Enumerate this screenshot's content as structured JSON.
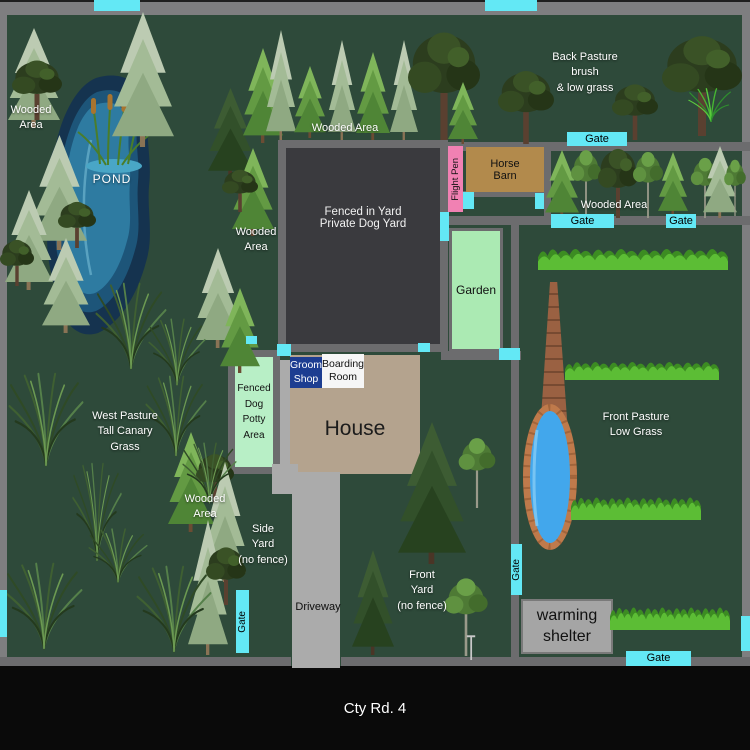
{
  "bottom_road_label": "Cty Rd. 4",
  "areas": {
    "pond": "POND",
    "fenced_yard": "Fenced in Yard\nPrivate Dog Yard",
    "garden": "Garden",
    "horse_barn": "Horse\nBarn",
    "flight_pen": "Flight Pen",
    "house": "House",
    "groom_shop": "Groom\nShop",
    "boarding_room": "Boarding\nRoom",
    "potty_area": "Fenced\nDog\nPotty\nArea",
    "warming_shelter": "warming\nshelter",
    "driveway": "Driveway"
  },
  "regions": {
    "wooded_nw": "Wooded\nArea",
    "wooded_top": "Wooded Area",
    "wooded_mid": "Wooded\nArea",
    "wooded_east": "Wooded Area",
    "wooded_sw": "Wooded\nArea",
    "back_pasture": "Back Pasture\nbrush\n& low grass",
    "west_pasture": "West Pasture\nTall Canary\nGrass",
    "front_pasture": "Front Pasture\nLow Grass",
    "side_yard": "Side\nYard\n(no fence)",
    "front_yard": "Front\nYard\n(no fence)"
  },
  "gates": [
    {
      "x": 94,
      "y": 0,
      "w": 46,
      "h": 11
    },
    {
      "x": 485,
      "y": 0,
      "w": 52,
      "h": 11
    },
    {
      "x": 567,
      "y": 132,
      "w": 60,
      "h": 14,
      "label": "Gate"
    },
    {
      "x": 551,
      "y": 214,
      "w": 63,
      "h": 14,
      "label": "Gate"
    },
    {
      "x": 666,
      "y": 214,
      "w": 30,
      "h": 14,
      "label": "Gate"
    },
    {
      "x": 463,
      "y": 192,
      "w": 11,
      "h": 17
    },
    {
      "x": 535,
      "y": 193,
      "w": 9,
      "h": 16
    },
    {
      "x": 440,
      "y": 212,
      "w": 9,
      "h": 29
    },
    {
      "x": 277,
      "y": 344,
      "w": 14,
      "h": 12
    },
    {
      "x": 418,
      "y": 343,
      "w": 12,
      "h": 9
    },
    {
      "x": 246,
      "y": 336,
      "w": 11,
      "h": 8
    },
    {
      "x": 499,
      "y": 348,
      "w": 21,
      "h": 12
    },
    {
      "x": 511,
      "y": 544,
      "w": 11,
      "h": 51,
      "label": "Gate",
      "vertical": true
    },
    {
      "x": 236,
      "y": 590,
      "w": 13,
      "h": 63,
      "label": "Gate",
      "vertical": true
    },
    {
      "x": 0,
      "y": 590,
      "w": 7,
      "h": 47
    },
    {
      "x": 626,
      "y": 651,
      "w": 65,
      "h": 15,
      "label": "Gate"
    },
    {
      "x": 741,
      "y": 616,
      "w": 9,
      "h": 35
    }
  ],
  "scenery": [
    [
      "cp",
      8,
      28,
      52,
      100
    ],
    [
      "dd",
      12,
      58,
      50,
      62
    ],
    [
      "cp",
      112,
      12,
      62,
      135
    ],
    [
      "cp",
      32,
      135,
      55,
      115
    ],
    [
      "cp",
      5,
      190,
      48,
      100
    ],
    [
      "dd",
      0,
      238,
      34,
      48
    ],
    [
      "cp",
      42,
      238,
      48,
      95
    ],
    [
      "dd",
      58,
      200,
      38,
      48
    ],
    [
      "cd",
      208,
      88,
      45,
      90
    ],
    [
      "cb",
      232,
      148,
      42,
      88
    ],
    [
      "dd",
      222,
      168,
      36,
      44
    ],
    [
      "cp",
      196,
      248,
      44,
      100
    ],
    [
      "cb",
      220,
      288,
      40,
      85
    ],
    [
      "cb",
      243,
      48,
      40,
      95
    ],
    [
      "cp",
      266,
      30,
      30,
      110
    ],
    [
      "cb",
      294,
      66,
      32,
      72
    ],
    [
      "cp",
      328,
      40,
      28,
      100
    ],
    [
      "cb",
      356,
      52,
      34,
      88
    ],
    [
      "cp",
      390,
      40,
      28,
      100
    ],
    [
      "dd",
      408,
      28,
      72,
      112
    ],
    [
      "cb",
      448,
      82,
      30,
      62
    ],
    [
      "dd",
      498,
      68,
      56,
      76
    ],
    [
      "dd",
      612,
      82,
      46,
      58
    ],
    [
      "dd",
      662,
      32,
      80,
      104
    ],
    [
      "tuftb",
      688,
      88,
      46,
      34
    ],
    [
      "cb",
      545,
      150,
      34,
      68
    ],
    [
      "dg",
      568,
      148,
      36,
      70
    ],
    [
      "dd",
      598,
      146,
      40,
      72
    ],
    [
      "dg",
      630,
      150,
      36,
      68
    ],
    [
      "cb",
      658,
      152,
      30,
      64
    ],
    [
      "dg",
      688,
      156,
      34,
      62
    ],
    [
      "cp",
      703,
      146,
      34,
      72
    ],
    [
      "dg",
      722,
      158,
      26,
      58
    ],
    [
      "cb",
      168,
      432,
      46,
      100
    ],
    [
      "dd",
      196,
      452,
      38,
      52
    ],
    [
      "cp",
      204,
      462,
      42,
      120
    ],
    [
      "cp",
      188,
      520,
      40,
      135
    ],
    [
      "dd",
      206,
      545,
      40,
      60
    ],
    [
      "cd",
      398,
      422,
      68,
      142
    ],
    [
      "dg",
      455,
      436,
      44,
      72
    ],
    [
      "cd",
      352,
      550,
      42,
      105
    ],
    [
      "dg",
      440,
      576,
      52,
      80
    ],
    [
      "pole",
      464,
      634,
      14,
      26
    ],
    [
      "tuft",
      95,
      282,
      72,
      88
    ],
    [
      "tuft",
      148,
      318,
      58,
      68
    ],
    [
      "tuft",
      8,
      372,
      76,
      95
    ],
    [
      "tuft",
      145,
      375,
      62,
      82
    ],
    [
      "tuft",
      182,
      442,
      55,
      62
    ],
    [
      "tuft",
      72,
      462,
      50,
      100
    ],
    [
      "tuft",
      88,
      528,
      60,
      55
    ],
    [
      "tuft",
      5,
      562,
      78,
      88
    ],
    [
      "tuft",
      136,
      565,
      76,
      88
    ],
    [
      "strip",
      538,
      242,
      190,
      28
    ],
    [
      "strip",
      565,
      356,
      154,
      24
    ],
    [
      "strip",
      571,
      490,
      130,
      30
    ],
    [
      "strip",
      610,
      600,
      120,
      30
    ]
  ],
  "colors": {
    "background": "#2e4a3a",
    "road": "#7e7e80",
    "road_bottom": "#0a0a0a",
    "fence": "#6c6c6e",
    "gate": "#63e8f5",
    "pond_outer": "#15334f",
    "pond_inner": "#2e7ba1",
    "house": "#b4a38e",
    "barn": "#b28a4c",
    "flight_pen": "#f181b3",
    "garden": "#abeab3",
    "potty": "#b8efc6",
    "fenced_yard": "#3a3a3e",
    "groom_shop": "#1d3d91",
    "boarding_room": "#f6f6f6",
    "warming_shelter": "#a5a5a5",
    "driveway": "#ababab",
    "pool_water": "#42a7ec",
    "pool_brick": "#bf7a4b",
    "tower_brick": "#9a6142"
  }
}
